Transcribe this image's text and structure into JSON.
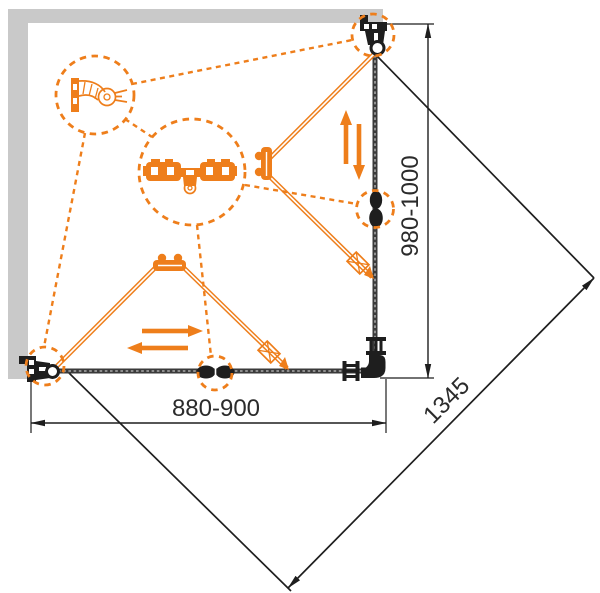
{
  "diagram": {
    "dimensions": {
      "width_label": "880-900",
      "height_label": "980-1000",
      "diagonal_label": "1345"
    },
    "colors": {
      "accent_orange": "#EE7E1B",
      "wall_gray": "#C9C9C9",
      "line_dark": "#1E1E1E",
      "text_dark": "#2B2B2B",
      "background": "#FFFFFF"
    },
    "icons": {
      "wall_profile_detail": "wall-profile-detail-icon",
      "roller_carriage_detail": "roller-carriage-detail-icon",
      "top_corner_pivot": "corner-pivot-icon",
      "panel_connector": "panel-connector-icon",
      "bottom_corner_pivot": "corner-pivot-icon",
      "floor_guide": "floor-guide-icon"
    }
  }
}
